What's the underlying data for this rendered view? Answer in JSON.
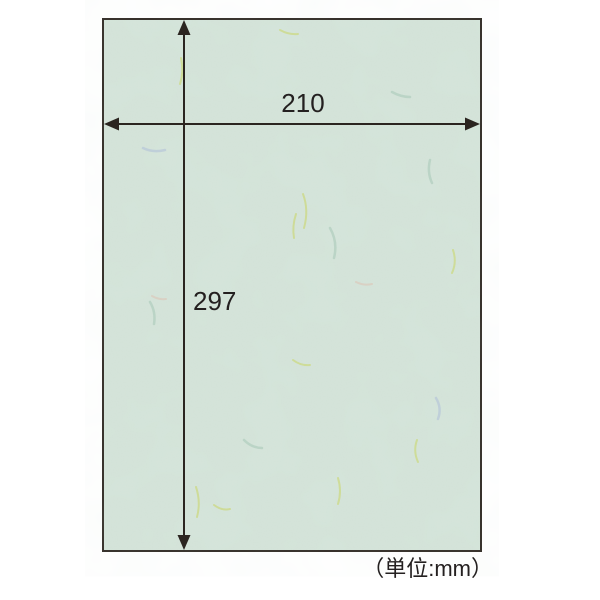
{
  "dimensions": {
    "width_label": "210",
    "height_label": "297",
    "unit_note": "（単位:mm）"
  },
  "colors": {
    "background": "#ffffff",
    "paper_fill": "#d6e5db",
    "paper_border": "#332d27",
    "line_color": "#2b2520",
    "text_color": "#242020",
    "fiber_yellow": "#ccd983",
    "fiber_green": "#b4cfc0",
    "fiber_blue": "#b7c6d8",
    "fiber_pink": "#dcc9ba"
  }
}
